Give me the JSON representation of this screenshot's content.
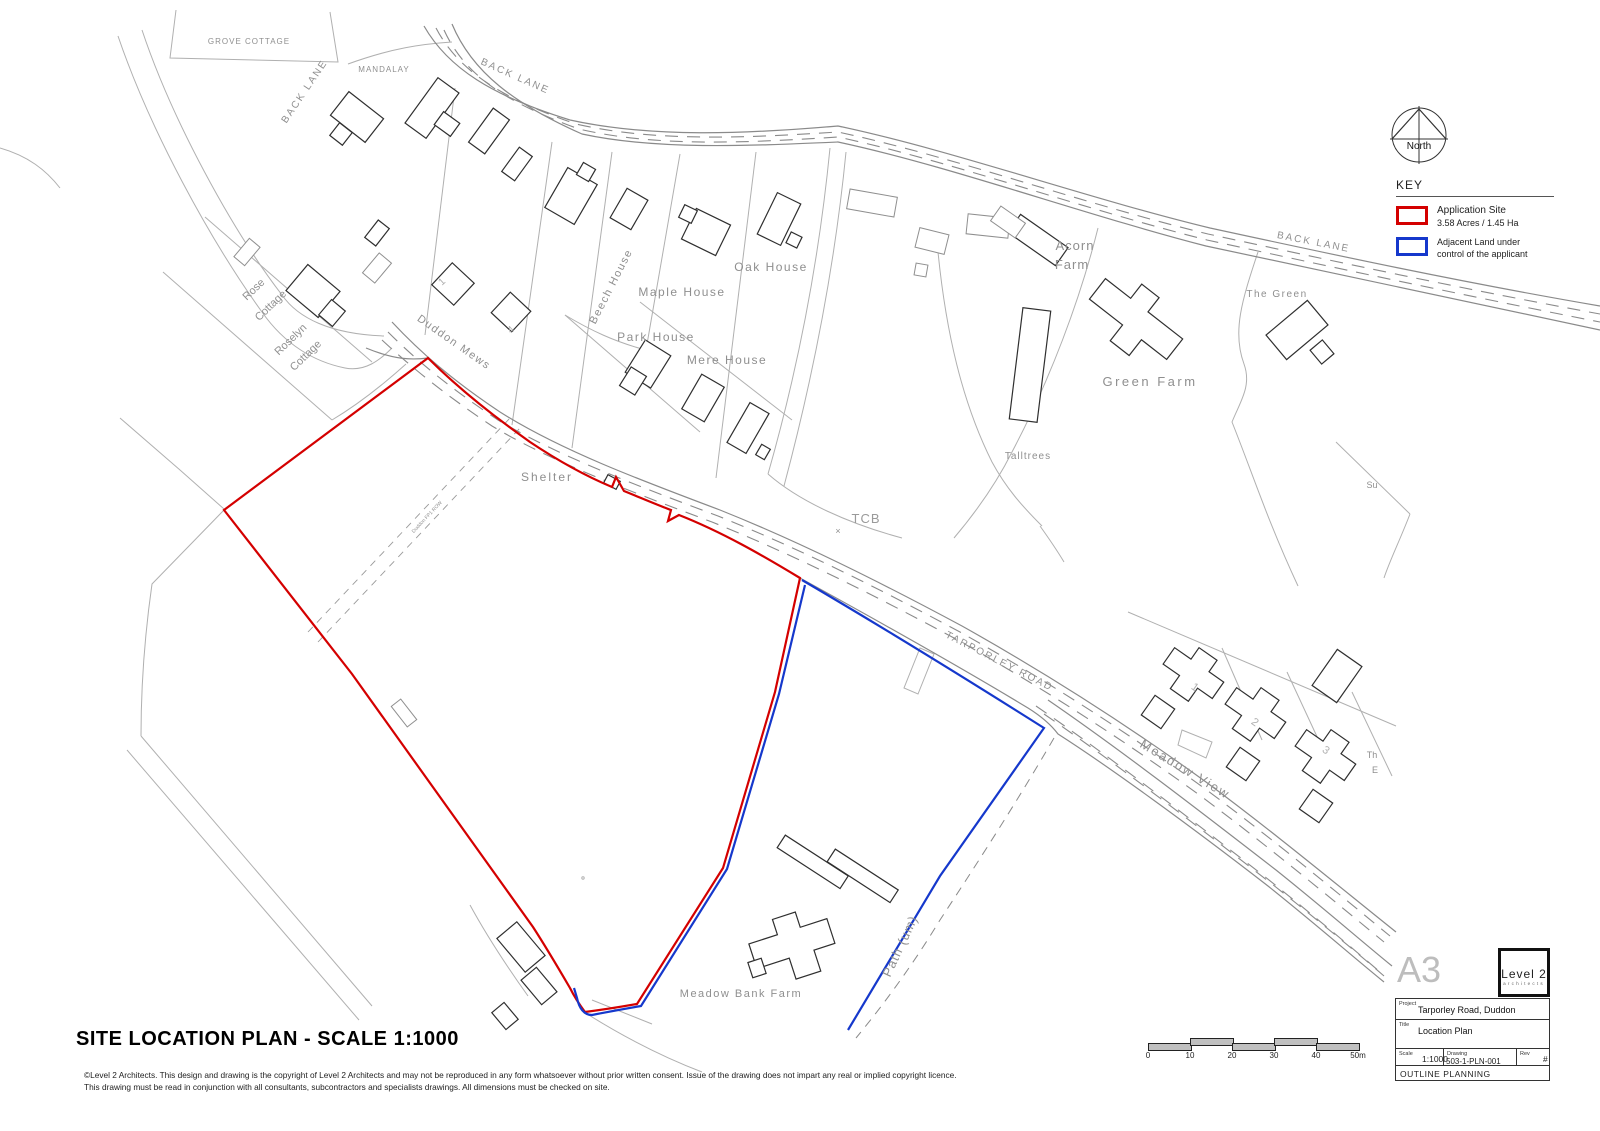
{
  "north": {
    "label": "North"
  },
  "key": {
    "heading": "KEY",
    "items": [
      {
        "color": "#d40000",
        "label1": "Application Site",
        "label2": "3.58 Acres / 1.45 Ha"
      },
      {
        "color": "#1538cc",
        "label1": "Adjacent Land under",
        "label2": "control of the applicant"
      }
    ]
  },
  "titleblock": {
    "paper": "A3",
    "logo_line1": "Level 2",
    "logo_line2": "architects",
    "project_label": "Project",
    "project": "Tarporley Road, Duddon",
    "title_label": "Title",
    "title": "Location Plan",
    "scale_label": "Scale",
    "scale": "1:1000",
    "drawing_label": "Drawing",
    "drawing": "503-1-PLN-001",
    "rev_label": "Rev",
    "rev": "#",
    "status": "OUTLINE PLANNING"
  },
  "scalebar": {
    "ticks": [
      "0",
      "10",
      "20",
      "30",
      "40",
      "50m"
    ]
  },
  "footer": {
    "title": "SITE LOCATION PLAN - SCALE 1:1000",
    "disclaimer1": "©Level 2 Architects. This design and drawing is the copyright of Level 2 Architects and may not be reproduced in any form whatsoever without prior written consent. Issue of the drawing does not impart any real or implied copyright licence.",
    "disclaimer2": "This drawing must be read in conjunction with all consultants, subcontractors and specialists drawings. All dimensions must be checked on site."
  },
  "colors": {
    "application_site": "#d40000",
    "adjacent_land": "#1538cc"
  },
  "map_labels": [
    {
      "id": "grove-cottage",
      "text": "GROVE COTTAGE",
      "x": 249,
      "y": 44,
      "rot": 0,
      "fs": 8,
      "ls": 1
    },
    {
      "id": "back-lane-west",
      "text": "BACK LANE",
      "x": 307,
      "y": 93,
      "rot": -56,
      "fs": 10,
      "ls": 2
    },
    {
      "id": "mandalay",
      "text": "MANDALAY",
      "x": 384,
      "y": 72,
      "rot": 0,
      "fs": 8,
      "ls": 1
    },
    {
      "id": "back-lane-top",
      "text": "BACK LANE",
      "x": 514,
      "y": 79,
      "rot": 24,
      "fs": 10,
      "ls": 2
    },
    {
      "id": "back-lane-east",
      "text": "BACK LANE",
      "x": 1313,
      "y": 245,
      "rot": 11,
      "fs": 10,
      "ls": 2
    },
    {
      "id": "rose",
      "text": "Rose",
      "x": 256,
      "y": 292,
      "rot": -44,
      "fs": 11
    },
    {
      "id": "rose-cottage",
      "text": "Cottage",
      "x": 273,
      "y": 308,
      "rot": -44,
      "fs": 11
    },
    {
      "id": "roselyn",
      "text": "Roselyn",
      "x": 293,
      "y": 342,
      "rot": -44,
      "fs": 11
    },
    {
      "id": "roselyn-cottage",
      "text": "Cottage",
      "x": 308,
      "y": 358,
      "rot": -44,
      "fs": 11
    },
    {
      "id": "duddon-mews",
      "text": "Duddon Mews",
      "x": 452,
      "y": 345,
      "rot": 35,
      "fs": 11,
      "ls": 1.5
    },
    {
      "id": "beech-house",
      "text": "Beech House",
      "x": 614,
      "y": 288,
      "rot": -63,
      "fs": 11,
      "ls": 1.5
    },
    {
      "id": "maple-house",
      "text": "Maple House",
      "x": 682,
      "y": 296,
      "rot": 0,
      "fs": 12,
      "ls": 1.5
    },
    {
      "id": "park-house",
      "text": "Park House",
      "x": 656,
      "y": 341,
      "rot": 0,
      "fs": 12,
      "ls": 1.5
    },
    {
      "id": "mere-house",
      "text": "Mere House",
      "x": 727,
      "y": 364,
      "rot": 0,
      "fs": 12,
      "ls": 1.5
    },
    {
      "id": "oak-house",
      "text": "Oak House",
      "x": 771,
      "y": 271,
      "rot": 0,
      "fs": 12,
      "ls": 1.5
    },
    {
      "id": "acorn-farm-1",
      "text": "Acorn",
      "x": 1075,
      "y": 250,
      "rot": 0,
      "fs": 13,
      "ls": 1
    },
    {
      "id": "acorn-farm-2",
      "text": "Farm",
      "x": 1072,
      "y": 269,
      "rot": 0,
      "fs": 13,
      "ls": 1
    },
    {
      "id": "the-green",
      "text": "The Green",
      "x": 1277,
      "y": 297,
      "rot": 0,
      "fs": 10,
      "ls": 1.5
    },
    {
      "id": "green-farm",
      "text": "Green Farm",
      "x": 1150,
      "y": 386,
      "rot": 0,
      "fs": 13,
      "ls": 2.5
    },
    {
      "id": "talltrees",
      "text": "Talltrees",
      "x": 1028,
      "y": 459,
      "rot": 0,
      "fs": 10,
      "ls": 1
    },
    {
      "id": "tcb",
      "text": "TCB",
      "x": 866,
      "y": 523,
      "rot": 0,
      "fs": 13,
      "ls": 1,
      "color": "#9a9a9a"
    },
    {
      "id": "tcb-cross",
      "text": "×",
      "x": 838,
      "y": 534,
      "rot": 0,
      "fs": 9
    },
    {
      "id": "shelter",
      "text": "Shelter",
      "x": 547,
      "y": 481,
      "rot": 0,
      "fs": 12,
      "ls": 2
    },
    {
      "id": "duddon-fp1-row",
      "text": "Duddon FP1 ROW",
      "x": 428,
      "y": 518,
      "rot": -47,
      "fs": 5
    },
    {
      "id": "tarporley-road",
      "text": "TARPORLEY ROAD",
      "x": 998,
      "y": 664,
      "rot": 27,
      "fs": 10,
      "ls": 2
    },
    {
      "id": "meadow-view",
      "text": "Meadow View",
      "x": 1183,
      "y": 773,
      "rot": 31,
      "fs": 13,
      "ls": 2
    },
    {
      "id": "path-um",
      "text": "Path (um)",
      "x": 904,
      "y": 948,
      "rot": -65,
      "fs": 13,
      "ls": 1
    },
    {
      "id": "meadow-bank-farm",
      "text": "Meadow Bank Farm",
      "x": 741,
      "y": 997,
      "rot": 0,
      "fs": 11,
      "ls": 1.5
    },
    {
      "id": "su-partial",
      "text": "Su",
      "x": 1372,
      "y": 488,
      "rot": 0,
      "fs": 9
    },
    {
      "id": "no1-meadow-view",
      "text": "1",
      "x": 1193,
      "y": 690,
      "rot": 35,
      "fs": 11,
      "color": "#b0b0b0"
    },
    {
      "id": "no2-meadow-view",
      "text": "2",
      "x": 1253,
      "y": 725,
      "rot": 35,
      "fs": 11,
      "color": "#b0b0b0"
    },
    {
      "id": "no3-meadow-view",
      "text": "3",
      "x": 1324,
      "y": 753,
      "rot": 35,
      "fs": 11,
      "color": "#b0b0b0"
    },
    {
      "id": "no1-duddon-mews",
      "text": "1",
      "x": 444,
      "y": 284,
      "rot": -42,
      "fs": 10,
      "color": "#b0b0b0"
    },
    {
      "id": "no4-duddon-mews",
      "text": "4",
      "x": 513,
      "y": 332,
      "rot": -42,
      "fs": 10,
      "color": "#b0b0b0"
    },
    {
      "id": "th-partial",
      "text": "Th",
      "x": 1372,
      "y": 758,
      "rot": 0,
      "fs": 9
    },
    {
      "id": "e-partial",
      "text": "E",
      "x": 1375,
      "y": 773,
      "rot": 0,
      "fs": 9
    }
  ]
}
